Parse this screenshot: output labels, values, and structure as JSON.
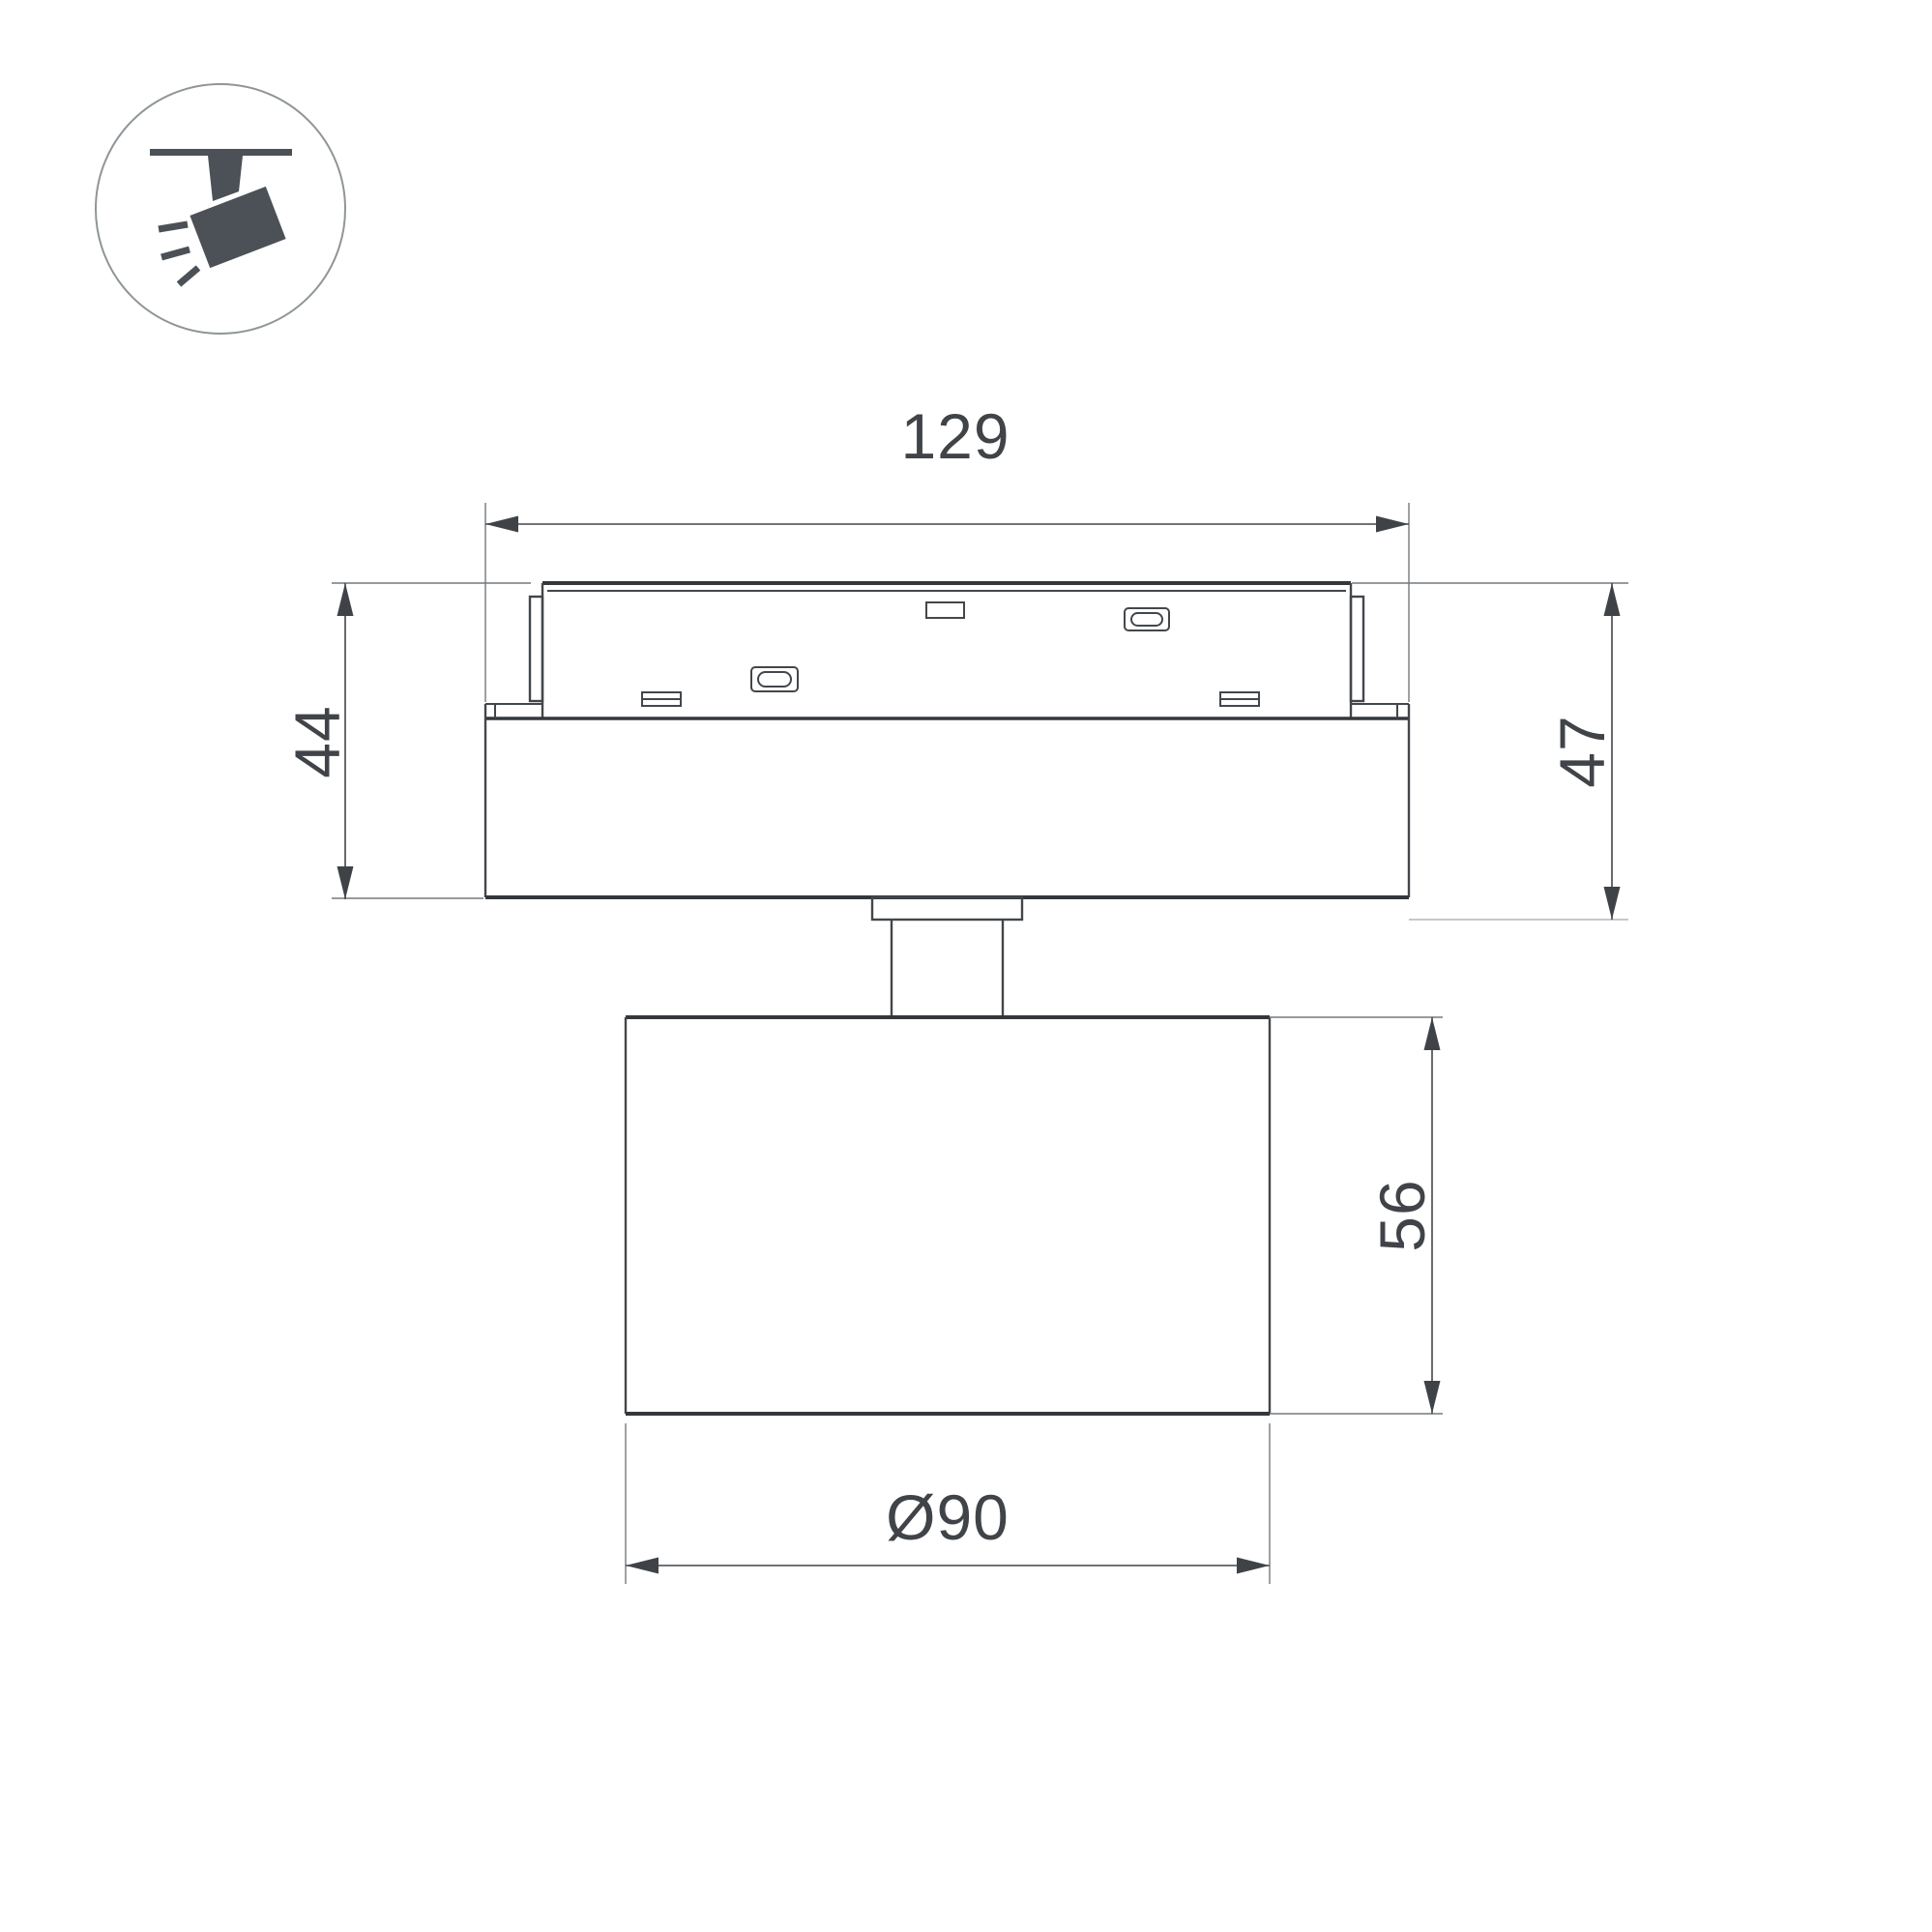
{
  "drawing": {
    "title": "track-spotlight-dimension-drawing",
    "view": "side-elevation",
    "dimensions": {
      "adapter_width": "129",
      "base_height": "44",
      "mount_total_height": "47",
      "head_height": "56",
      "head_diameter": "Ø90"
    },
    "icon": {
      "name": "track-spotlight-icon",
      "description": "circled pictogram of a spotlight hanging from a ceiling track"
    },
    "colors": {
      "background": "#ffffff",
      "outline": "#34383c",
      "detail_line": "#43474b",
      "dimension_line": "#42464a",
      "extension_line": "#74797d",
      "light_reference_line": "#b2b5b7",
      "text": "#404448",
      "icon_fill": "#4b5156",
      "icon_circle_stroke": "#8f9598"
    }
  }
}
